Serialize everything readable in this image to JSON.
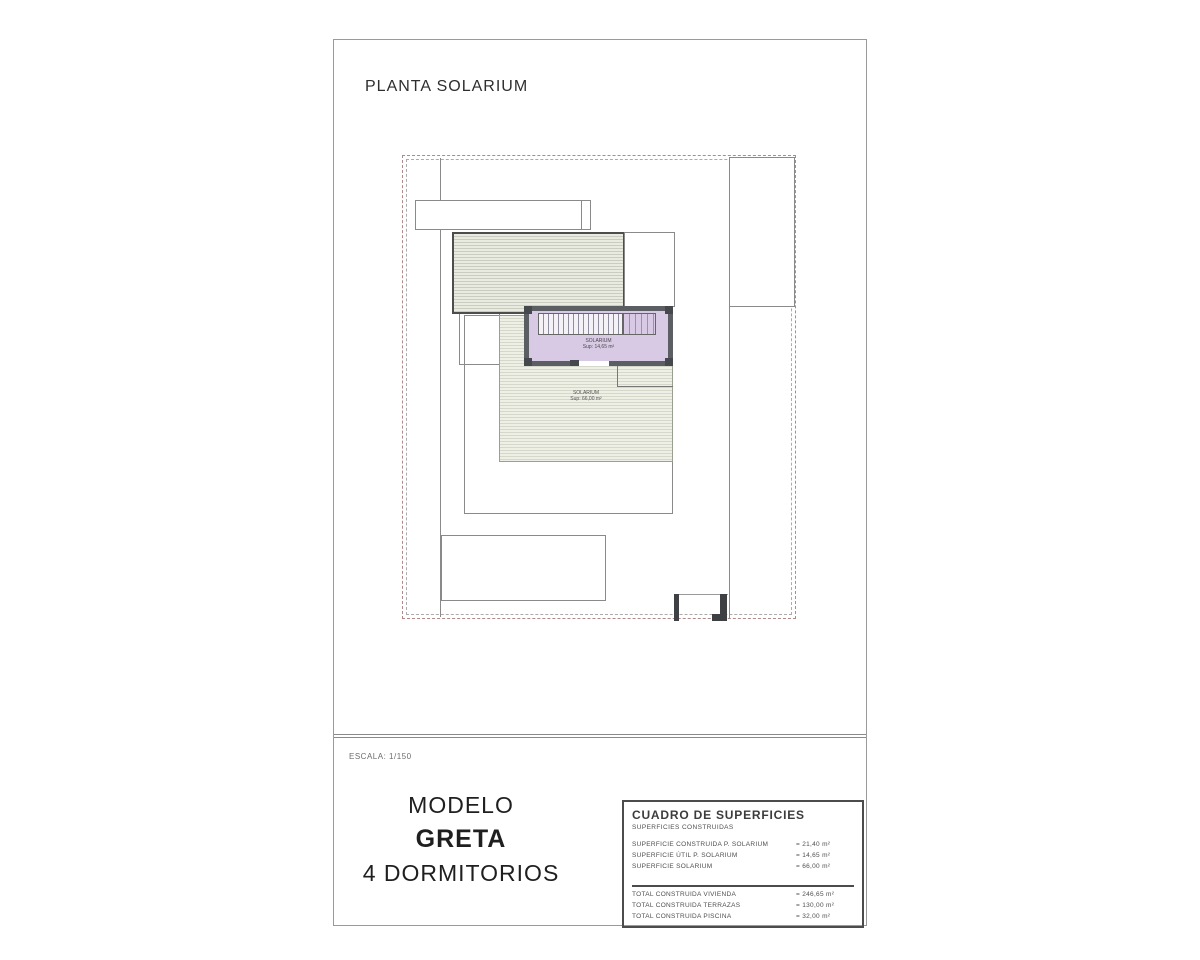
{
  "sheet": {
    "title": "PLANTA SOLARIUM",
    "scale_label": "ESCALA: 1/150"
  },
  "model": {
    "line1": "MODELO",
    "line2": "GRETA",
    "line3": "4 DORMITORIOS"
  },
  "plan": {
    "solarium_room_label": {
      "line1": "SOLARIUM",
      "line2": "Sup: 14,65 m²"
    },
    "terrace_label": {
      "line1": "SOLARIUM",
      "line2": "Sup: 66,00 m²"
    },
    "colors": {
      "boundary_dash": "#b08a8a",
      "drawing_line": "#8a8a8a",
      "roof_fill": "#e9ebe1",
      "terrace_fill": "#eef0e6",
      "solarium_fill": "#d8c9e5",
      "wall": "#5b5f63"
    }
  },
  "surfaces_table": {
    "title": "CUADRO DE SUPERFICIES",
    "subtitle": "SUPERFICIES CONSTRUIDAS",
    "rows": [
      {
        "label": "SUPERFICIE CONSTRUIDA P. SOLARIUM",
        "value": "= 21,40 m²"
      },
      {
        "label": "SUPERFICIE ÚTIL P. SOLARIUM",
        "value": "= 14,65 m²"
      },
      {
        "label": "SUPERFICIE SOLARIUM",
        "value": "= 66,00 m²"
      }
    ],
    "totals": [
      {
        "label": "TOTAL CONSTRUIDA VIVIENDA",
        "value": "= 246,65 m²"
      },
      {
        "label": "TOTAL CONSTRUIDA TERRAZAS",
        "value": "= 130,00 m²"
      },
      {
        "label": "TOTAL CONSTRUIDA PISCINA",
        "value": "= 32,00 m²"
      }
    ]
  }
}
